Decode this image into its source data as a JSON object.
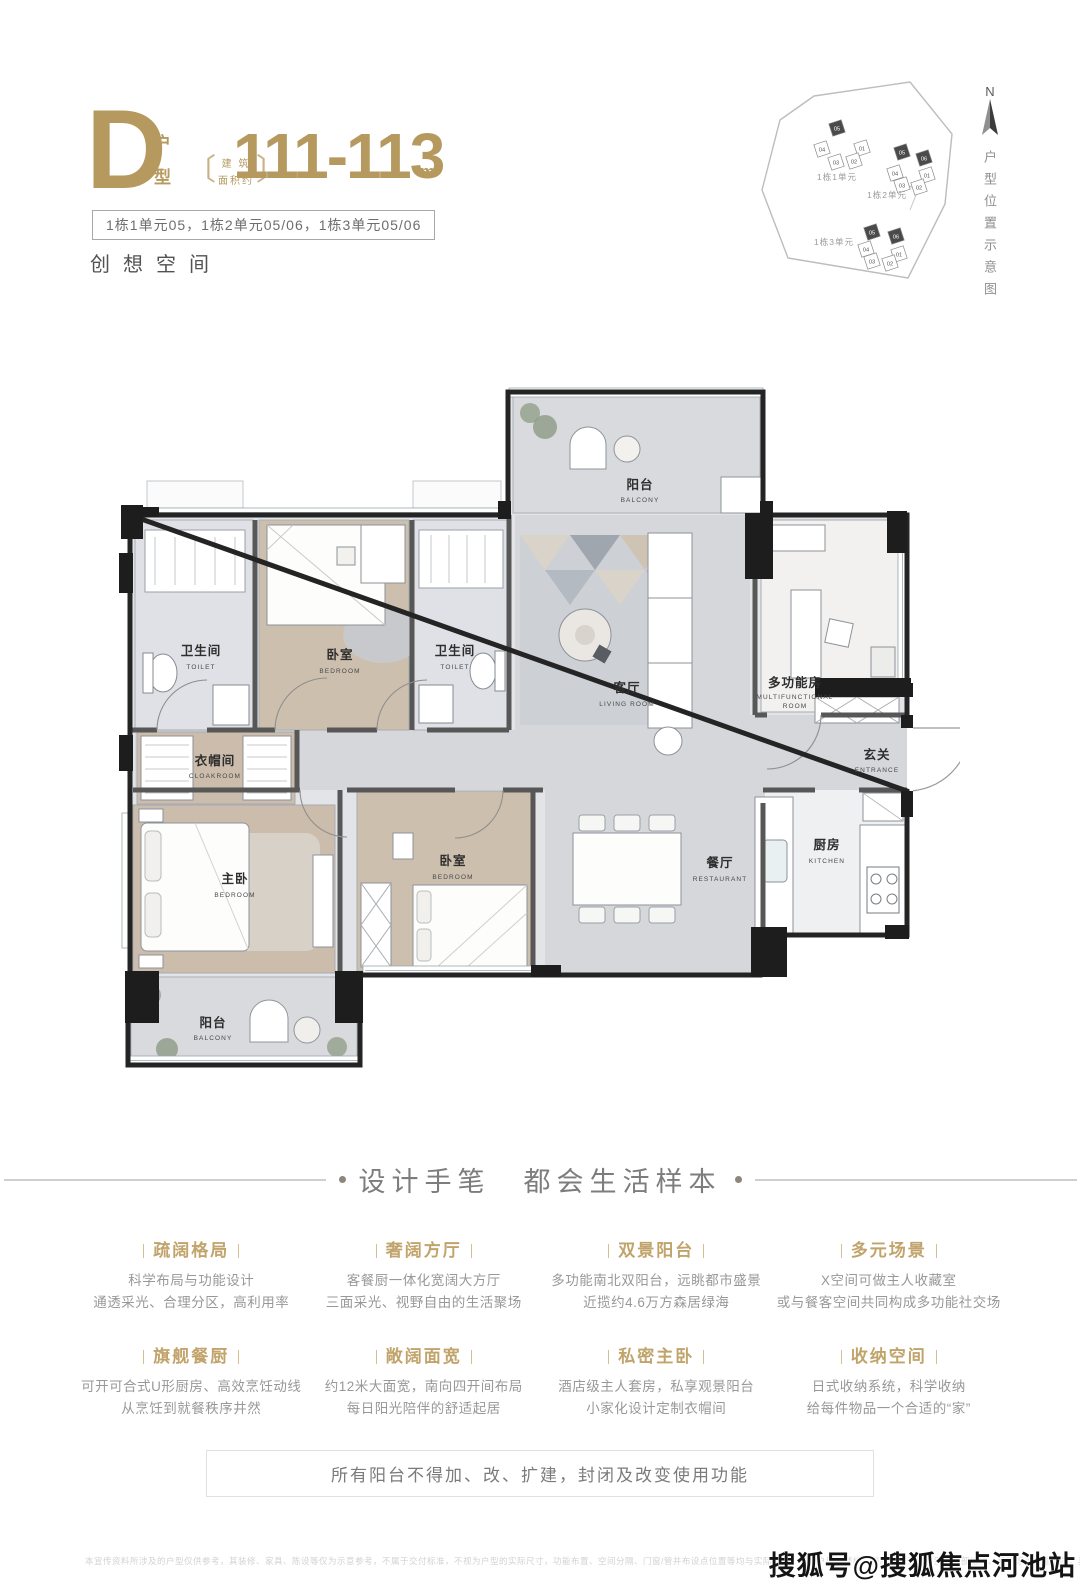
{
  "header": {
    "type_letter": "D",
    "type_char_1": "户",
    "type_char_2": "型",
    "area_note_open": "〔",
    "area_note_line1": "建 筑",
    "area_note_line2": "面积约",
    "area_note_close": "〕",
    "area_value": "111-113",
    "area_unit": "m²",
    "units_line": "1栋1单元05，1栋2单元05/06，1栋3单元05/06",
    "slogan": "创想空间"
  },
  "site_plan": {
    "compass": "N",
    "side_caption": "户型位置示意图",
    "clusters": [
      {
        "label": "1栋1单元",
        "units": [
          {
            "no": "05",
            "hl": true
          },
          {
            "no": "04"
          },
          {
            "no": "01"
          },
          {
            "no": "03"
          },
          {
            "no": "02"
          }
        ]
      },
      {
        "label": "1栋2单元",
        "units": [
          {
            "no": "05",
            "hl": true
          },
          {
            "no": "06",
            "hl": true
          },
          {
            "no": "04"
          },
          {
            "no": "03"
          },
          {
            "no": "01"
          },
          {
            "no": "02"
          }
        ]
      },
      {
        "label": "1栋3单元",
        "units": [
          {
            "no": "05",
            "hl": true
          },
          {
            "no": "06",
            "hl": true
          },
          {
            "no": "04"
          },
          {
            "no": "03"
          },
          {
            "no": "01"
          },
          {
            "no": "02"
          }
        ]
      }
    ]
  },
  "floor_plan": {
    "rooms": {
      "balcony_top": {
        "zh": "阳台",
        "en": "BALCONY"
      },
      "toilet_left": {
        "zh": "卫生间",
        "en": "TOILET"
      },
      "bedroom_top": {
        "zh": "卧室",
        "en": "BEDROOM"
      },
      "toilet_right": {
        "zh": "卫生间",
        "en": "TOILET"
      },
      "living": {
        "zh": "客厅",
        "en": "LIVING ROOM"
      },
      "multi": {
        "zh": "多功能房",
        "en1": "MULTIFUNCTIONAL",
        "en2": "ROOM"
      },
      "entrance": {
        "zh": "玄关",
        "en": "ENTRANCE"
      },
      "cloakroom": {
        "zh": "衣帽间",
        "en": "CLOAKROOM"
      },
      "master": {
        "zh": "主卧",
        "en": "BEDROOM"
      },
      "bedroom_mid": {
        "zh": "卧室",
        "en": "BEDROOM"
      },
      "dining": {
        "zh": "餐厅",
        "en": "RESTAURANT"
      },
      "kitchen": {
        "zh": "厨房",
        "en": "KITCHEN"
      },
      "balcony_bottom": {
        "zh": "阳台",
        "en": "BALCONY"
      }
    }
  },
  "section": {
    "heading": "设计手笔　都会生活样本"
  },
  "features": [
    {
      "title": "疏阔格局",
      "line1": "科学布局与功能设计",
      "line2": "通透采光、合理分区，高利用率"
    },
    {
      "title": "奢阔方厅",
      "line1": "客餐厨一体化宽阔大方厅",
      "line2": "三面采光、视野自由的生活聚场"
    },
    {
      "title": "双景阳台",
      "line1": "多功能南北双阳台，远眺都市盛景",
      "line2": "近揽约4.6万方森居绿海"
    },
    {
      "title": "多元场景",
      "line1": "X空间可做主人收藏室",
      "line2": "或与餐客空间共同构成多功能社交场"
    },
    {
      "title": "旗舰餐厨",
      "line1": "可开可合式U形厨房、高效烹饪动线",
      "line2": "从烹饪到就餐秩序井然"
    },
    {
      "title": "敞阔面宽",
      "line1": "约12米大面宽，南向四开间布局",
      "line2": "每日阳光陪伴的舒适起居"
    },
    {
      "title": "私密主卧",
      "line1": "酒店级主人套房，私享观景阳台",
      "line2": "小家化设计定制衣帽间"
    },
    {
      "title": "收纳空间",
      "line1": "日式收纳系统，科学收纳",
      "line2": "给每件物品一个合适的“家”"
    }
  ],
  "notice": "所有阳台不得加、改、扩建，封闭及改变使用功能",
  "disclaimer": "本宣传资料所涉及的户型仅供参考，其装修、家具、陈设等仅为示意参考，不属于交付标准，不视为户型的实际尺寸，功能布置、空间分隔、门窗/管井布设点位置等均与实际不同；相同户型因楼栋、楼层、单元等差别，局部结构、面积等也可能不同，具体以实际交付为准",
  "watermark": "搜狐号@搜狐焦点河池站",
  "colors": {
    "gold": "#b5995e",
    "feature_gold": "#c1a46b",
    "wall": "#1d1d1d",
    "wood": "#cbbcab",
    "marble": "#d5d7db"
  }
}
